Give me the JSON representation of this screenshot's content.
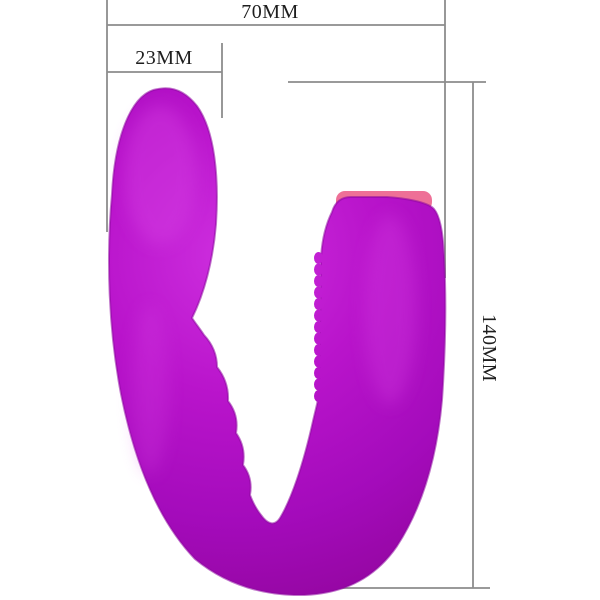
{
  "dimensions": {
    "width_label": "70MM",
    "head_width_label": "23MM",
    "height_label": "140MM",
    "line_color": "#8c8c8c",
    "label_color": "#1e1e1e"
  },
  "product": {
    "description": "purple u-shaped silicone massager",
    "colors": {
      "light": "#ce2fdf",
      "base": "#b914cb",
      "shade": "#a40bbb",
      "dark": "#93069f",
      "edge": "#8d059e",
      "accent_pink": "#ee7097"
    }
  }
}
